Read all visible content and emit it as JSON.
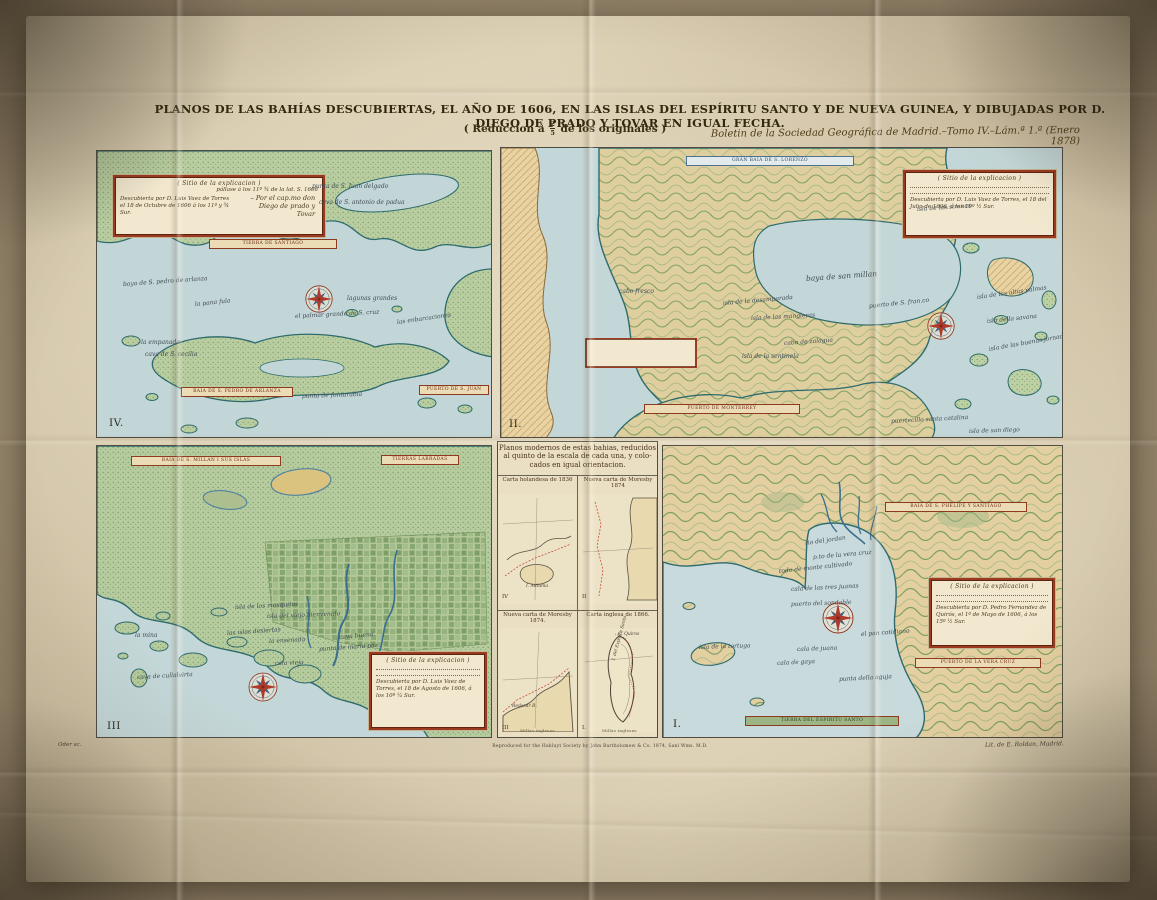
{
  "header": {
    "title": "PLANOS DE LAS BAHÍAS DESCUBIERTAS, EL AÑO DE 1606, EN LAS ISLAS DEL ESPÍRITU SANTO Y DE NUEVA GUINEA, Y DIBUJADAS POR D. DIEGO DE PRADO Y TOVAR EN IGUAL FECHA.",
    "reduction_pre": "( Reduccion á",
    "reduction_num": "2",
    "reduction_den": "5",
    "reduction_post": "de los originales )",
    "boletin": "Boletin de la Sociedad Geográfica de Madrid.–Tomo IV.–Lám.ª 1.ª (Enero 1878)"
  },
  "footer": {
    "engraver": "Oder sc.",
    "imprint": "Reproduced for the Hakluyt Society by John Bartholomew & Co. 1874, Sanl Wms. M.D.",
    "lithographer": "Lit. de E. Roldan, Madrid."
  },
  "colors": {
    "sea": "#c4d7d8",
    "land_green": "#b9cda0",
    "land_tan": "#e4cfa0",
    "coast_ink": "#2e6b6e",
    "cartouche_red": "#9c3a1f",
    "ribbon_red": "#8d3a20",
    "ribbon_blue": "#4f7392",
    "compass_red": "#b03a2a",
    "compass_blue": "#46607a",
    "title_ink": "#31280f"
  },
  "panel_iv": {
    "number": "IV.",
    "cartouche": {
      "heading": "( Sitio de la explicacion )",
      "note": "pállase á los 11º ¾ de la lat. S. 1606",
      "body": "Descubierta por D. Luis Vaez de Torres el 18 de Octubre de 1606 á los 11º y ¾ Sur.",
      "credit": "– Por el cap.mo don Diego de prado y Tovar"
    },
    "banners": {
      "top": "TIERRA DE SANTIAGO",
      "left": "BAIA DE S. PEDRO DE ARLANZA",
      "right": "PUERTO DE S. JUAN"
    },
    "labels": [
      {
        "text": "punta de S. Juan delgado"
      },
      {
        "text": "cava de S. antonio de padua"
      },
      {
        "text": "baya de S. pedro de arlanza"
      },
      {
        "text": "la pana fula"
      },
      {
        "text": "el palmar grande de S. cruz"
      },
      {
        "text": "lagunas grandes"
      },
      {
        "text": "las enbarcaciones"
      },
      {
        "text": "la empanada"
      },
      {
        "text": "cava de S. cecilia"
      },
      {
        "text": "punta de fontarabia"
      }
    ]
  },
  "panel_ii": {
    "number": "II.",
    "cartouche": {
      "heading": "( Sitio de la explicacion )",
      "body": "Descubierta por D. Luis Vaez de Torres, el 18 del Julio de 1606, á los 10º ½ Sur."
    },
    "banners": {
      "top": "GRAN BAIA DE S. LORENZO",
      "bottom": "PUERTO DE MONTERREY"
    },
    "labels": [
      {
        "text": "baya de san millan"
      },
      {
        "text": "cabo fresco"
      },
      {
        "text": "isla de la desamparada"
      },
      {
        "text": "isla de las mangleras"
      },
      {
        "text": "cabo de zalagua"
      },
      {
        "text": "isla de la sentinela"
      },
      {
        "text": "puerto de S. fran.co"
      },
      {
        "text": "isla de las sirenas"
      },
      {
        "text": "isla de las altas palmas"
      },
      {
        "text": "isla della savana"
      },
      {
        "text": "isla de las buenas jornadas"
      },
      {
        "text": "puertecillo santa catalina"
      },
      {
        "text": "isla de san diego"
      }
    ]
  },
  "panel_iii": {
    "number": "III",
    "cartouche": {
      "heading": "( Sitio de la explicacion )",
      "body": "Descubierta por D. Luis Vaez de Torres, el 18 de Agosto de 1606, á los 10º ¼ Sur."
    },
    "banners": {
      "left": "BAIA DE S. MILLAN I SUS ISLAS",
      "right": "TIERRAS LABRADAS"
    },
    "labels": [
      {
        "text": "isla de los mosquitos"
      },
      {
        "text": "isla del viejo bienvenido"
      },
      {
        "text": "las islas desiertas"
      },
      {
        "text": "la ensenada"
      },
      {
        "text": "cava buena"
      },
      {
        "text": "punta de maria paz"
      },
      {
        "text": "cala vieja"
      },
      {
        "text": "cava de cullalvirta"
      },
      {
        "text": "la mina"
      }
    ]
  },
  "panel_i": {
    "number": "I.",
    "cartouche": {
      "heading": "( Sitio de la explicacion )",
      "body": "Descubierta por D. Pedro Fernandez de Quirós, el 1º de Mayo de 1606, á los 15º ½ Sur."
    },
    "banners": {
      "top": "BAIA DE S. PHELIPE Y SANTIAGO",
      "mid": "PUERTO DE LA VERA CRUZ",
      "bottom": "TIERRA DEL ESPIRITU SANTO"
    },
    "labels": [
      {
        "text": "cala de las tres juanas"
      },
      {
        "text": "puerto del sondable"
      },
      {
        "text": "el pan cotidiano"
      },
      {
        "text": "cala de juana"
      },
      {
        "text": "cala de gaya"
      },
      {
        "text": "punta della aguja"
      },
      {
        "text": "isla de la tortuga"
      },
      {
        "text": "p.to de la vera cruz"
      },
      {
        "text": "rio del jordan"
      },
      {
        "text": "todo de monte cultivado"
      }
    ]
  },
  "center_panel": {
    "heading_line1": "Planos modernos de estas bahias, reducidos",
    "heading_line2": "al quinto de la escala de cada una, y colo-",
    "heading_line3": "cados en igual orientacion.",
    "cells": [
      {
        "caption": "Carta holandesa de 1836",
        "corner": "IV",
        "label": "I. Aiduma"
      },
      {
        "caption": "Nueva carta de Moresby 1874",
        "corner": "II",
        "label": ""
      },
      {
        "caption": "Nueva carta de Moresby 1874.",
        "corner": "III",
        "label": "Redscar B."
      },
      {
        "caption": "Carta inglesa de 1866.",
        "corner": "I.",
        "label": "I. del Espiritu Santo",
        "label2": "C. Quiros"
      }
    ],
    "scale_note": "Millas inglesas"
  }
}
